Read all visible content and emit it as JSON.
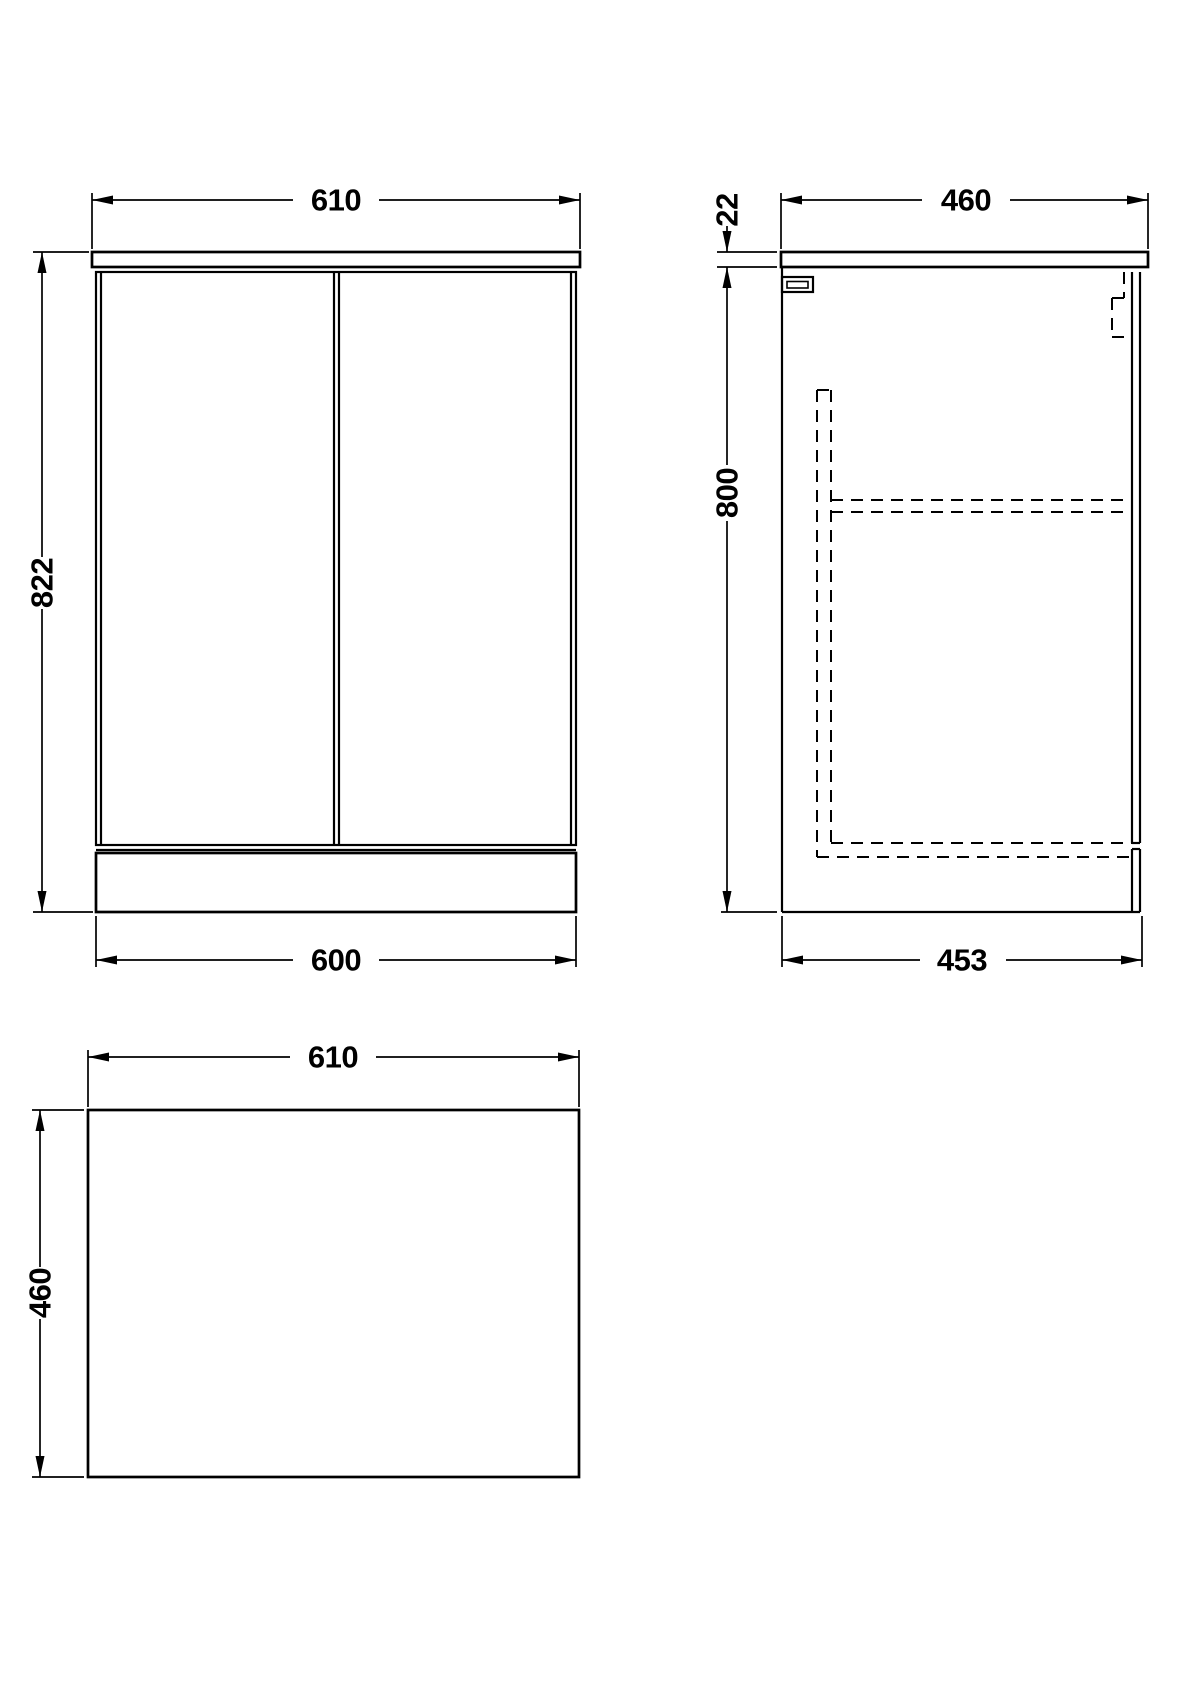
{
  "document": {
    "background_color": "#ffffff",
    "line_color": "#000000",
    "hidden_line_style": "dashed"
  },
  "views": {
    "front": {
      "dims": {
        "width": "610",
        "height": "822",
        "base_width": "600"
      }
    },
    "side": {
      "dims": {
        "depth": "460",
        "worktop_thickness": "22",
        "height": "800",
        "base_depth": "453"
      }
    },
    "plan": {
      "dims": {
        "width": "610",
        "depth": "460"
      }
    }
  }
}
